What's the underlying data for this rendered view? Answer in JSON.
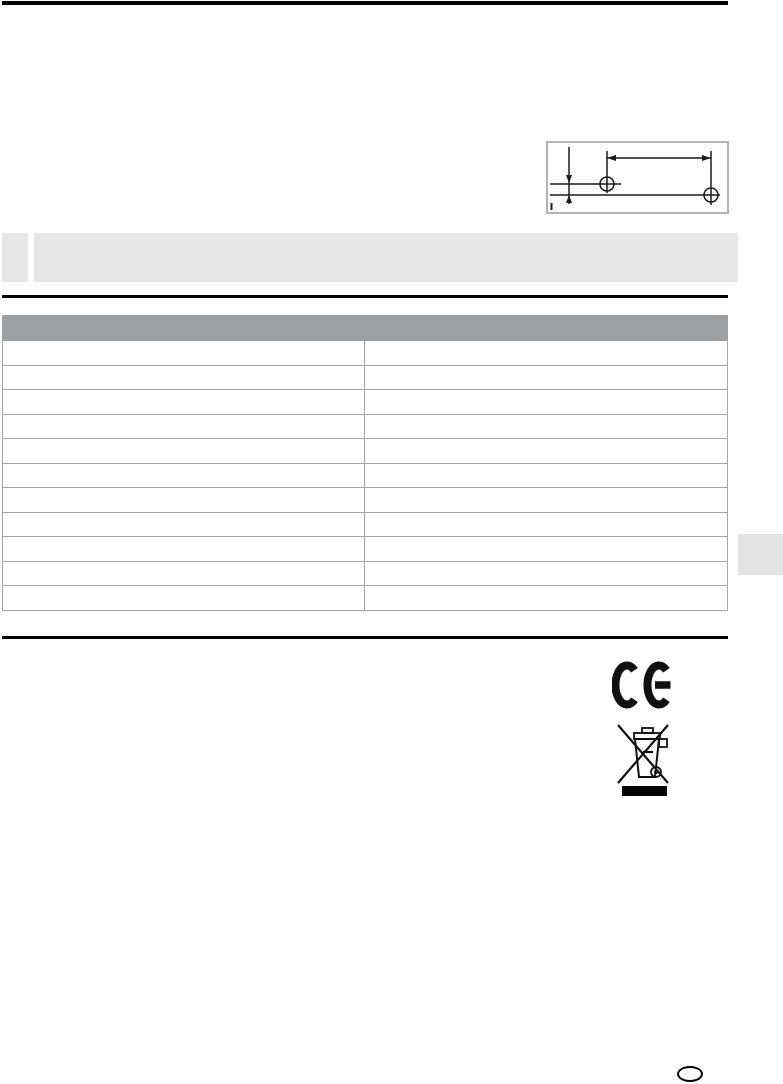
{
  "document": {
    "title": "",
    "note": {
      "text": ""
    },
    "figure": {
      "caption": "",
      "description_icon": "drill-hole-dimension-drawing"
    },
    "table": {
      "header_label": "",
      "rows": [
        {
          "label": "",
          "value": ""
        },
        {
          "label": "",
          "value": ""
        },
        {
          "label": "",
          "value": ""
        },
        {
          "label": "",
          "value": ""
        },
        {
          "label": "",
          "value": ""
        },
        {
          "label": "",
          "value": ""
        },
        {
          "label": "",
          "value": ""
        },
        {
          "label": "",
          "value": ""
        },
        {
          "label": "",
          "value": ""
        },
        {
          "label": "",
          "value": ""
        },
        {
          "label": "",
          "value": ""
        }
      ]
    },
    "symbols": {
      "ce_mark_icon": "ce-mark",
      "weee_icon": "weee-crossed-out-wheeled-bin"
    },
    "page_number": ""
  },
  "colors": {
    "note_bg": "#e7e7e7",
    "table_header_bg": "#9da0a2",
    "table_border": "#a6a6a6",
    "side_tab_bg": "#e3e4e4",
    "rule": "#000000",
    "figure_border": "#b3b3b3"
  }
}
